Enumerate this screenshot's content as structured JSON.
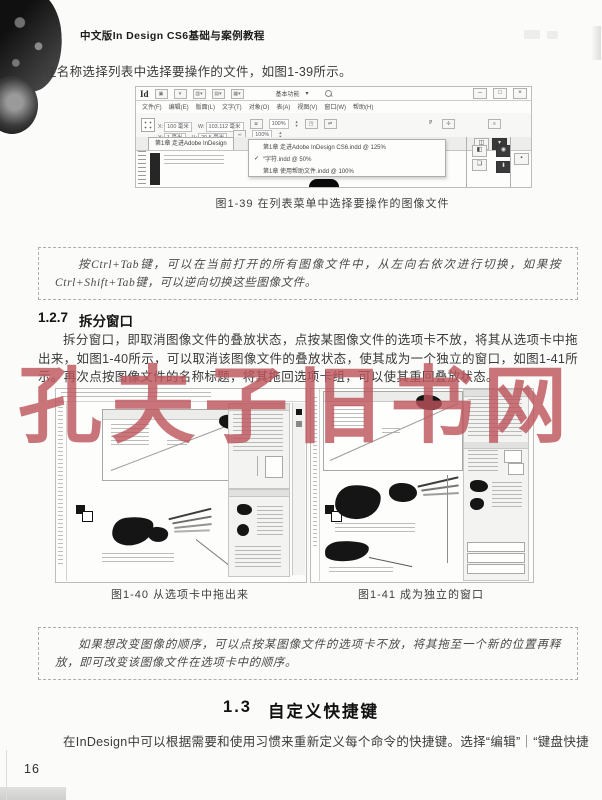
{
  "page": {
    "header_title": "中文版In Design CS6基础与案例教程",
    "page_number": "16",
    "watermark": "孔夫子旧书网"
  },
  "intro_line": "性名称选择列表中选择要操作的文件，如图1-39所示。",
  "fig139": {
    "caption": "图1-39 在列表菜单中选择要操作的图像文件",
    "logo": "Id",
    "workspace_label": "基本功能",
    "menus": [
      "文件(F)",
      "编辑(E)",
      "版面(L)",
      "文字(T)",
      "对象(O)",
      "表(A)",
      "视图(V)",
      "窗口(W)",
      "帮助(H)"
    ],
    "fields": {
      "x_label": "X:",
      "x_value": "100 毫米",
      "y_label": "Y:",
      "y_value": "1 毫米",
      "w_label": "W:",
      "w_value": "103.112 毫米",
      "h_label": "H:",
      "h_value": "20.5 毫米",
      "scale1": "100%",
      "scale2": "100%"
    },
    "tab_label": "第1章 走进Adobe InDesign",
    "dropdown_items": [
      {
        "check": "",
        "label": "第1章 走进Adobe InDesign CS6.indd @ 125%"
      },
      {
        "check": "✓",
        "label": "“字符.indd @ 50%"
      },
      {
        "check": "",
        "label": "第1章 使用帮助文件.indd @ 100%"
      }
    ],
    "window_buttons": {
      "minimize": "─",
      "maximize": "□",
      "close": "×"
    },
    "p_mark": "P"
  },
  "tip1": "按Ctrl+Tab键，可以在当前打开的所有图像文件中，从左向右依次进行切换，如果按Ctrl+Shift+Tab键，可以逆向切换这些图像文件。",
  "section_127": {
    "number": "1.2.7",
    "title": "拆分窗口"
  },
  "para_127": "拆分窗口，即取消图像文件的叠放状态，点按某图像文件的选项卡不放，将其从选项卡中拖出来，如图1-40所示，可以取消该图像文件的叠放状态，使其成为一个独立的窗口，如图1-41所示。再次点按图像文件的名称标题，将其拖回选项卡组，可以使其重回叠放状态。",
  "fig140": {
    "caption": "图1-40 从选项卡中拖出来"
  },
  "fig141": {
    "caption": "图1-41 成为独立的窗口"
  },
  "tip2": "如果想改变图像的顺序，可以点按某图像文件的选项卡不放，将其拖至一个新的位置再释放，即可改变该图像文件在选项卡中的顺序。",
  "section_13": {
    "number": "1.3",
    "title": "自定义快捷键"
  },
  "para_13": "在InDesign中可以根据需要和使用习惯来重新定义每个命令的快捷键。选择“编辑”｜“键盘快捷"
}
